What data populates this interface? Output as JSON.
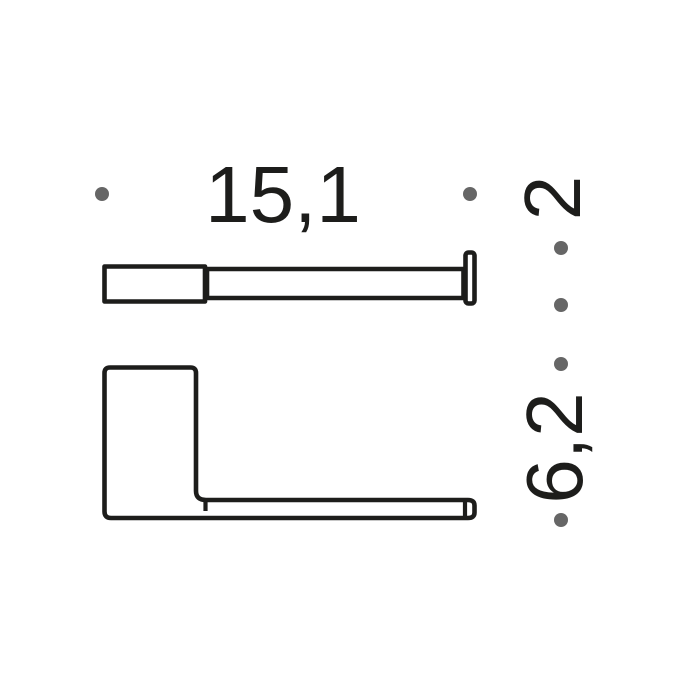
{
  "drawing": {
    "type": "technical-dimension-drawing",
    "dimensions": {
      "width_label": "15,1",
      "depth_label": "2",
      "height_label": "6,2"
    },
    "colors": {
      "line": "#1d1d1b",
      "dot": "#666666",
      "text": "#1d1d1b",
      "background": "#ffffff"
    }
  }
}
